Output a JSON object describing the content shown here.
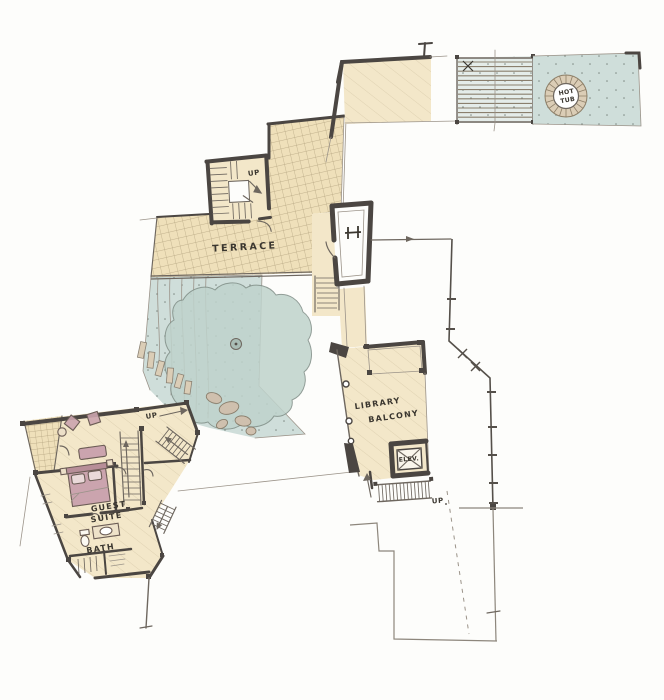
{
  "labels": {
    "terrace": "TERRACE",
    "hot_tub": [
      "HOT",
      "TUB"
    ],
    "library_balcony": [
      "LIBRARY",
      "BALCONY"
    ],
    "guest_suite": [
      "GUEST",
      "SUITE"
    ],
    "bath": "BATH",
    "elevator": "ELEV.",
    "up_stair_tower": "UP",
    "up_garden_path": "UP",
    "up_library_stairs": "UP"
  },
  "colors": {
    "paper": "#fdfdfb",
    "cream": "#f3e7c9",
    "cream_deep": "#efe0ba",
    "wash": "#cfdeda",
    "wash_deep": "#bfd3cc",
    "pink": "#cba4ae",
    "pink_deep": "#b78e98",
    "wall": "#4b4642",
    "line_mid": "#6e675f",
    "line_light": "#9b9389",
    "hatch": "#b2a27e",
    "tan": "#cfc0ae",
    "stone": "#dbcdb6",
    "dot": "#7e8a84",
    "ink": "#3a362f"
  }
}
